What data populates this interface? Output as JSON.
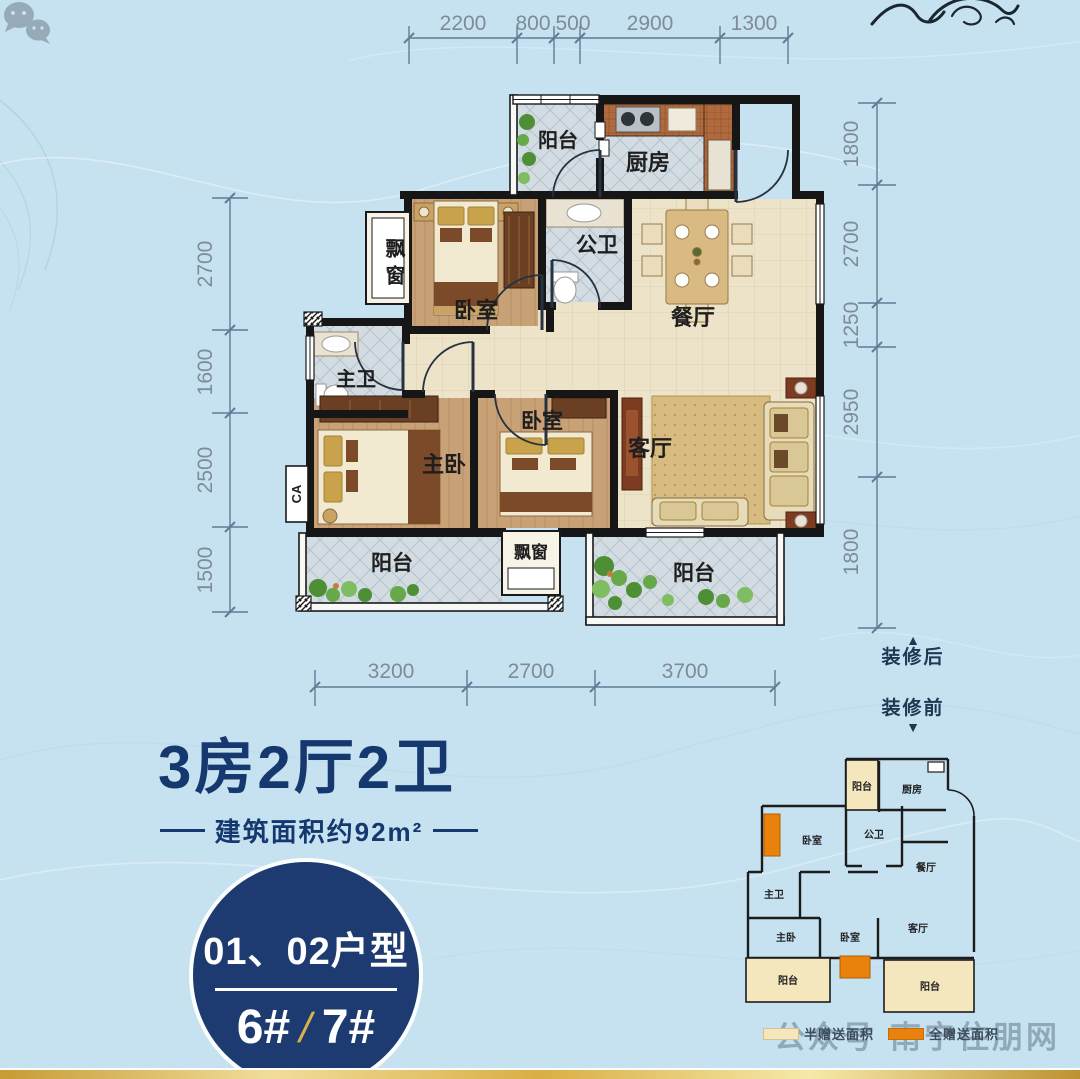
{
  "colors": {
    "background": "#c6e2f1",
    "navy": "#1d3b70",
    "gold": "#d8b34c",
    "orange": "#e8820c",
    "cream": "#f4e7bd",
    "wall": "#161616",
    "dim_text": "#7e8b99"
  },
  "dims": {
    "top": [
      "2200",
      "800",
      "500",
      "2900",
      "1300"
    ],
    "left": [
      "2700",
      "1600",
      "2500",
      "1500"
    ],
    "right": [
      "1800",
      "2700",
      "1250",
      "2950",
      "1800"
    ],
    "bottom": [
      "3200",
      "2700",
      "3700"
    ]
  },
  "plan": {
    "balcony_top": "阳台",
    "kitchen": "厨房",
    "bay_window_side": "飘窗",
    "bedroom_top": "卧室",
    "public_bath": "公卫",
    "dining": "餐厅",
    "master_bath": "主卫",
    "master_bedroom": "主卧",
    "bedroom_mid": "卧室",
    "living": "客厅",
    "balcony_left": "阳台",
    "bay_window_bottom": "飘窗",
    "balcony_right": "阳台",
    "duct": "CA"
  },
  "title": {
    "headline": "3房2厅2卫",
    "area_note": "建筑面积约92m²"
  },
  "badge": {
    "units": "01、02户型",
    "building_a": "6#",
    "slash": "/",
    "building_b": "7#"
  },
  "inset": {
    "after": "装修后",
    "before": "装修前",
    "arrow_up": "▲",
    "arrow_down": "▼",
    "balcony_top": "阳台",
    "kitchen": "厨房",
    "bedroom_top": "卧室",
    "public_bath": "公卫",
    "dining": "餐厅",
    "master_bath": "主卫",
    "master_bedroom": "主卧",
    "bedroom_mid": "卧室",
    "living": "客厅",
    "balcony_left": "阳台",
    "balcony_right": "阳台"
  },
  "legend": {
    "half": "半赠送面积",
    "full": "全赠送面积"
  },
  "watermark": {
    "platform": "公众号",
    "separator": "·",
    "site": "南宁住朋网"
  }
}
